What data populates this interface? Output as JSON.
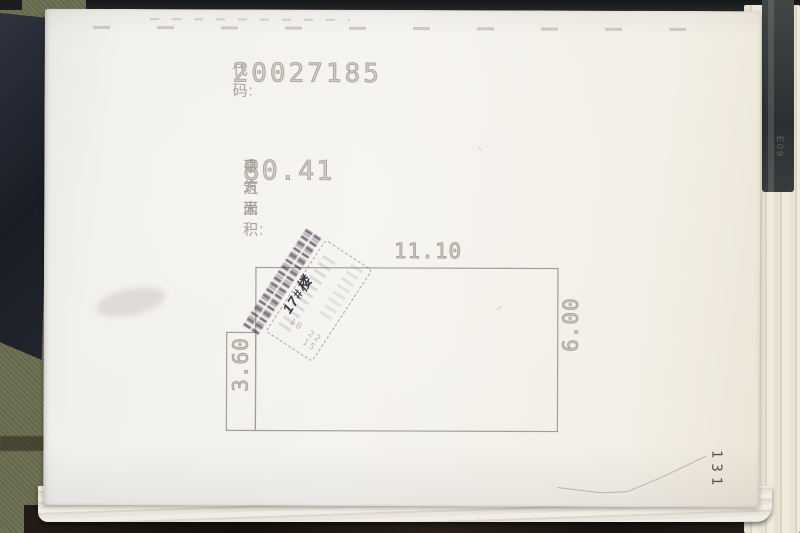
{
  "document": {
    "code_label": "代码:",
    "code_value": "20027185",
    "area_label": "建筑面积:",
    "area_value": "80.41",
    "area_unit": "平方米",
    "page_number": "131"
  },
  "floor_plan": {
    "top_dimension": "11.10",
    "right_dimension": "6.00",
    "left_dimension": "3.60"
  },
  "stamp": {
    "handwritten_note": "17#楼",
    "inner_marks": "10 22 15"
  },
  "side_objects": {
    "spine_text": "E09"
  },
  "colors": {
    "paper": "#f2f0ec",
    "print_gray": "#a6a29a",
    "plan_line": "#a29e98",
    "stamp_ink": "#5a5264",
    "handwriting_ink": "#3c3842",
    "page_number_ink": "#56524b",
    "desk_olive": "#6d7052",
    "desk_dark_object": "#23262e",
    "desk_shadow": "#1c1510"
  }
}
